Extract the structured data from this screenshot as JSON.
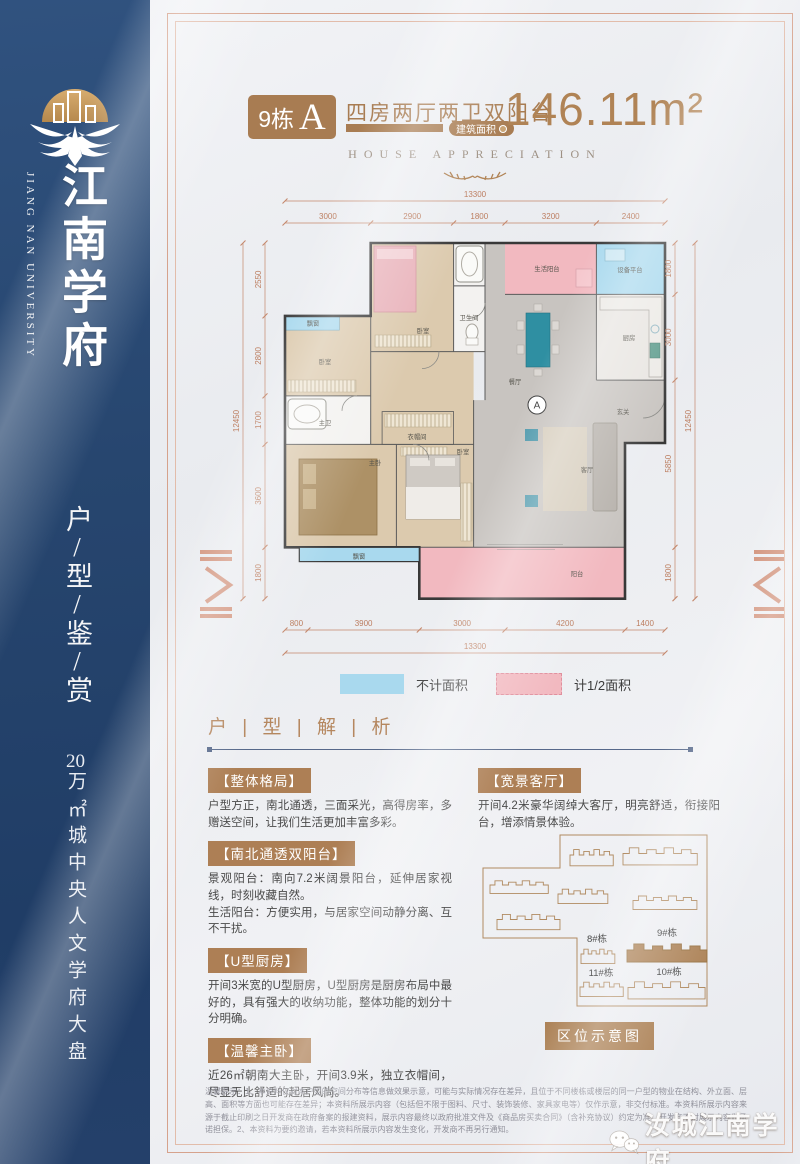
{
  "sidebar": {
    "brand_cn": "江南学府",
    "brand_en": "JIANG NAN UNIVERSITY",
    "slogan": "户/型/鉴/赏",
    "tagline_num": "20",
    "tagline_rest": "万㎡城中央人文学府大盘"
  },
  "header": {
    "building_no": "9栋",
    "unit_letter": "A",
    "subtitle": "四房两厅两卫双阳台",
    "area_label": "建筑面积",
    "area_value": "146.11m²",
    "english_caption": "HOUSE APPRECIATION"
  },
  "plan": {
    "dims_top": {
      "total": "13300",
      "segments": [
        "3000",
        "2900",
        "1800",
        "3200",
        "2400"
      ]
    },
    "dims_bottom": {
      "total": "13300",
      "segments": [
        "800",
        "3900",
        "3000",
        "4200",
        "1400"
      ]
    },
    "dims_left": {
      "total": "12450",
      "segments": [
        "2550",
        "2800",
        "1700",
        "3600",
        "1800"
      ]
    },
    "dims_right": {
      "total": "12450",
      "segments": [
        "1800",
        "3000",
        "5850",
        "1800"
      ]
    },
    "rooms": {
      "bay_window_top": "飘窗",
      "bedroom_left": "卧室",
      "bedroom_top": "卧室",
      "bathroom": "卫生间",
      "service_balcony": "生活阳台",
      "equipment_platform": "设备平台",
      "dining": "餐厅",
      "kitchen": "厨房",
      "entry": "玄关",
      "master_bath": "主卫",
      "cloakroom": "衣帽间",
      "master_bedroom": "主卧",
      "bedroom_bottom": "卧室",
      "living": "客厅",
      "balcony": "阳台",
      "bay_window_bottom": "飘窗",
      "unit_marker": "A"
    },
    "legend": [
      {
        "label": "不计面积",
        "swatch": "#a9d9ee",
        "style": "solid"
      },
      {
        "label": "计1/2面积",
        "swatch": "#f2b9c0",
        "style": "dashed"
      }
    ]
  },
  "analysis": {
    "title": "户 | 型 | 解 | 析",
    "sections": [
      {
        "title": "【整体格局】",
        "body": "户型方正，南北通透，三面采光，高得房率，多赠送空间，让我们生活更加丰富多彩。"
      },
      {
        "title": "【南北通透双阳台】",
        "body": "景观阳台：南向7.2米阔景阳台，延伸居家视线，时刻收藏自然。\n生活阳台：方便实用，与居家空间动静分离、互不干扰。"
      },
      {
        "title": "【U型厨房】",
        "body": "开间3米宽的U型厨房，U型厨房是厨房布局中最好的，具有强大的收纳功能，整体功能的划分十分明确。"
      },
      {
        "title": "【温馨主卧】",
        "body": "近26㎡朝南大主卧，开间3.9米，独立衣帽间，尽显无比舒适的起居风尚。"
      },
      {
        "title": "【宽景客厅】",
        "body": "开间4.2米豪华阔绰大客厅，明亮舒适，衔接阳台，增添情景体验。"
      }
    ]
  },
  "map": {
    "title": "区位示意图",
    "labels": [
      "8#栋",
      "9#栋",
      "11#栋",
      "10#栋"
    ]
  },
  "disclaimer": "温馨提示：1、本资料仅对本户型的空间分布等信息做效果示意，可能与实际情况存在差异，且位于不同楼栋或楼层的同一户型的物业在结构、外立面、层高、面积等方面也可能存在差异；本资料所展示内容（包括但不限于图料、尺寸、装饰装修、家具家电等）仅作示意，非交付标准。本资料所展示内容来源于截止印刷之日开发商在政府备案的报建资料，展示内容最终以政府批准文件及《商品房买卖合同》（含补充协议）约定为准。开发商不对展示内容做承诺担保。2、本资料为要约邀请，若本资料所展示内容发生变化，开发商不再另行通知。",
  "watermark": "汝城江南学府",
  "colors": {
    "accent_brown": "#a87c52",
    "dim_line": "#c4876b",
    "navy_sidebar": "#27456e",
    "legend_blue": "#a9d9ee",
    "legend_pink": "#f2b9c0",
    "wall": "#3a3a3a"
  }
}
